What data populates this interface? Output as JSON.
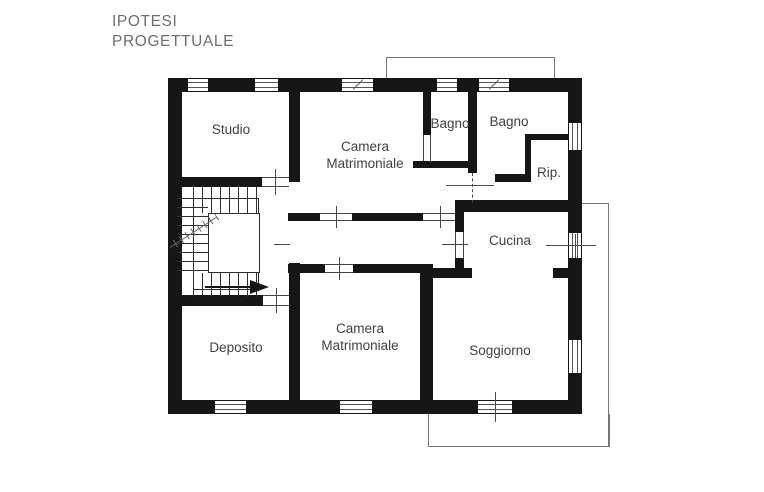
{
  "title": {
    "line1": "IPOTESI",
    "line2": "PROGETTUALE"
  },
  "colors": {
    "wall": "#161616",
    "label": "#414141",
    "title": "#6e6e6e",
    "background": "#ffffff"
  },
  "rooms": [
    {
      "name": "studio",
      "lines": [
        "Studio"
      ]
    },
    {
      "name": "camera-matrimoniale-top",
      "lines": [
        "Camera",
        "Matrimoniale"
      ]
    },
    {
      "name": "bagno-left",
      "lines": [
        "Bagno"
      ]
    },
    {
      "name": "bagno-right",
      "lines": [
        "Bagno"
      ]
    },
    {
      "name": "ripostiglio",
      "lines": [
        "Rip."
      ]
    },
    {
      "name": "cucina",
      "lines": [
        "Cucina"
      ]
    },
    {
      "name": "deposito",
      "lines": [
        "Deposito"
      ]
    },
    {
      "name": "camera-matrimoniale-bottom",
      "lines": [
        "Camera",
        "Matrimoniale"
      ]
    },
    {
      "name": "soggiorno",
      "lines": [
        "Soggiorno"
      ]
    }
  ]
}
